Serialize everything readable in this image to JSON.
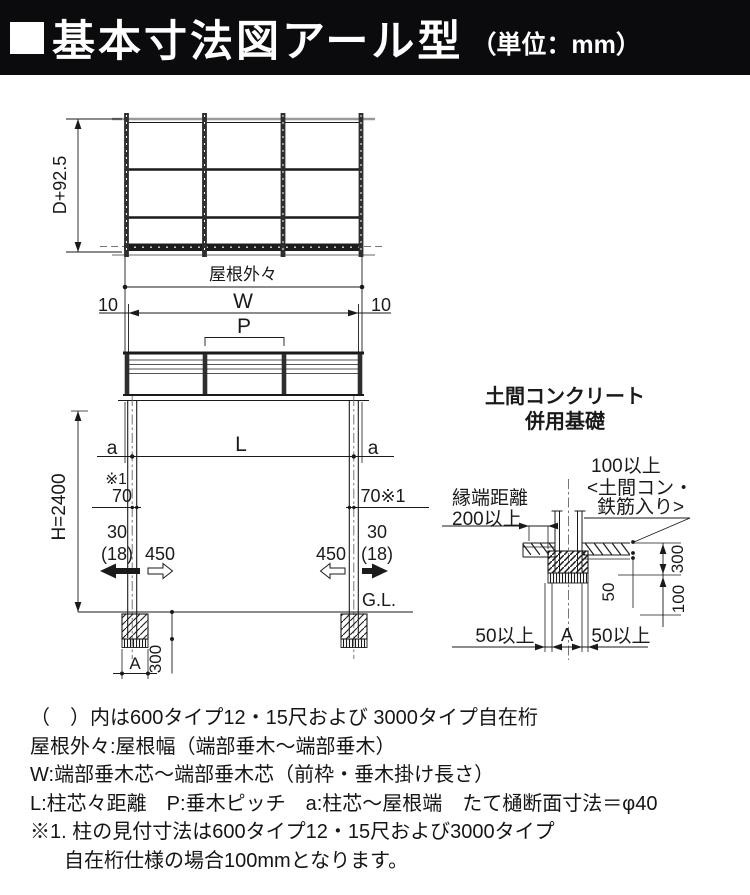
{
  "header": {
    "title": "基本寸法図アール型",
    "unit": "（単位：mm）"
  },
  "plan": {
    "depth_dim": "D+92.5",
    "roof_width_label": "屋根外々"
  },
  "front": {
    "ten_left": "10",
    "w": "W",
    "ten_right": "10",
    "p": "P",
    "a_left": "a",
    "l": "L",
    "a_right": "a",
    "note_ref": "※1",
    "seventy_left": "70",
    "seventy_right": "70※1",
    "thirty_left": "30",
    "thirty_paren_left": "(18)",
    "d450_left": "450",
    "d450_right": "450",
    "thirty_right": "30",
    "thirty_paren_right": "(18)",
    "h": "H=2400",
    "gl": "G.L.",
    "a_foundation": "A",
    "d300": "300"
  },
  "detail": {
    "title1": "土間コンクリート",
    "title2": "併用基礎",
    "edge1": "縁端距離",
    "edge2": "200以上",
    "slab1": "100以上",
    "slab2": "<土間コン・",
    "slab3": "鉄筋入り>",
    "d300": "300",
    "d100": "100",
    "d50": "50",
    "min50_left": "50以上",
    "a": "A",
    "min50_right": "50以上"
  },
  "notes": {
    "line1": "（　）内は600タイプ12・15尺および 3000タイプ自在桁",
    "line2": "屋根外々:屋根幅（端部垂木〜端部垂木）",
    "line3": "W:端部垂木芯〜端部垂木芯（前枠・垂木掛け長さ）",
    "line4": "L:柱芯々距離　P:垂木ピッチ　a:柱芯〜屋根端　たて樋断面寸法＝φ40",
    "line5": "※1. 柱の見付寸法は600タイプ12・15尺および3000タイプ",
    "line6": "自在桁仕様の場合100mmとなります。"
  },
  "colors": {
    "ink": "#1a1a1a",
    "header_bg": "#0b0b0d",
    "header_fg": "#ffffff"
  }
}
